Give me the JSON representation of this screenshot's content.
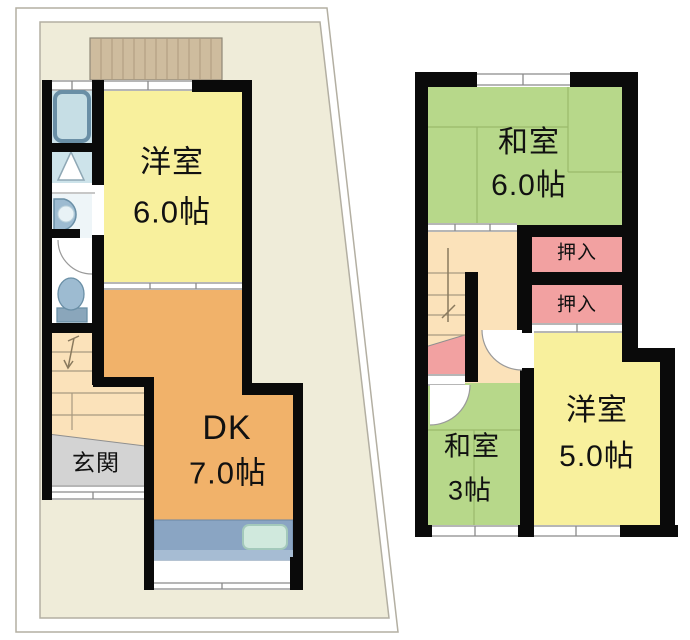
{
  "document_type": "floor-plan",
  "floor1": {
    "western_room": {
      "name": "洋室",
      "size": "6.0帖"
    },
    "dining_kitchen": {
      "name": "DK",
      "size": "7.0帖"
    },
    "entrance": {
      "name": "玄関"
    }
  },
  "floor2": {
    "japanese_room_6": {
      "name": "和室",
      "size": "6.0帖"
    },
    "closet_upper": {
      "name": "押入"
    },
    "closet_lower": {
      "name": "押入"
    },
    "japanese_room_3": {
      "name": "和室",
      "size": "3帖"
    },
    "western_room_5": {
      "name": "洋室",
      "size": "5.0帖"
    }
  },
  "colors": {
    "site_fill": "#efecd9",
    "site_line": "#b3afa2",
    "wall": "#0a0a0a",
    "room_yellow": "#f8f09d",
    "room_orange": "#f1b26a",
    "room_green": "#b7d88a",
    "closet_pink": "#f2a1a1",
    "hall_cream": "#fbe2ba",
    "entrance_gray": "#d3d3d3",
    "bath_blue": "#cde3ea",
    "fixture_blue": "#9dbbd1",
    "fixture_line": "#6a8fa6",
    "counter_blue": "#8aa5c3",
    "counter_strip": "#a6bcd3",
    "sink_green": "#d0e9dd",
    "balcony_tan": "#cebc9e",
    "balcony_line": "#ad9a7e",
    "winline": "#8a8a8a",
    "tatami_line": "#93b264",
    "text": "#111111"
  }
}
